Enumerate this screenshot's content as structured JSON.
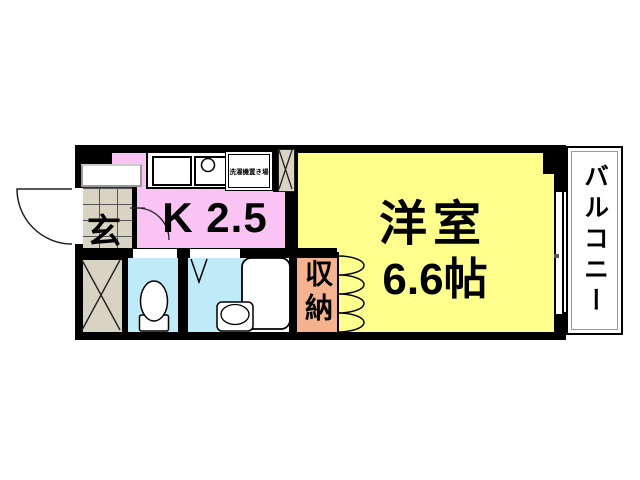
{
  "plan": {
    "type": "apartment-floor-plan",
    "labels": {
      "entrance": "玄",
      "kitchen": "K 2.5",
      "main_room_name": "洋室",
      "main_room_size": "6.6帖",
      "storage": "収納",
      "balcony": "バルコニー",
      "washing_machine": "洗濯機置き場"
    },
    "colors": {
      "kitchen_fill": "#f9c4f3",
      "main_room_fill": "#ffff8e",
      "storage_fill": "#f4b28e",
      "wet_room_fill": "#bfeaf7",
      "tile_fill": "#d8d3c3",
      "wall": "#000000",
      "background": "#ffffff"
    }
  }
}
